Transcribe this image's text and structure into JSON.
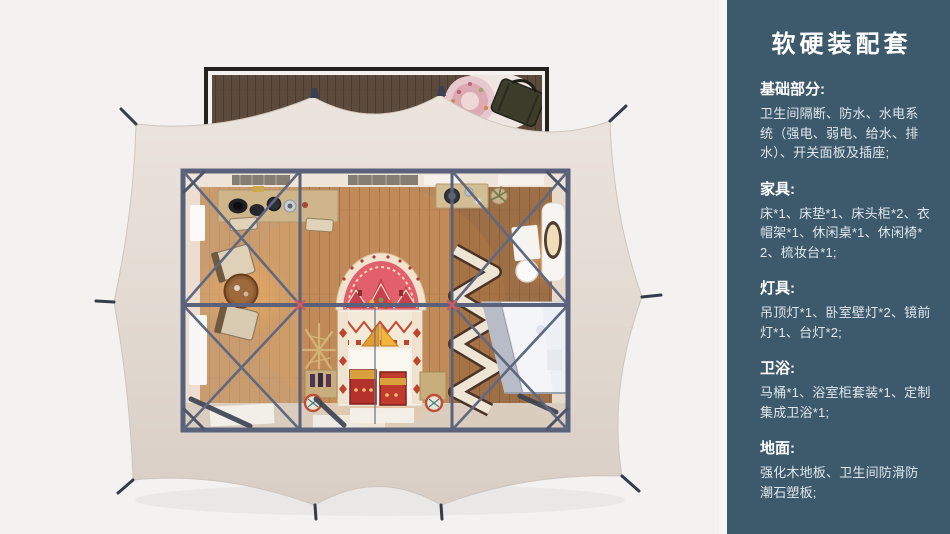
{
  "sidebar": {
    "title": "软硬装配套",
    "bg_color": "#3d5a6c",
    "text_color": "#dfe7ec",
    "sections": [
      {
        "heading": "基础部分:",
        "body": "卫生间隔断、防水、水电系统（强电、弱电、给水、排水）、开关面板及插座;"
      },
      {
        "heading": "家具:",
        "body": "床*1、床垫*1、床头柜*2、衣帽架*1、休闲桌*1、休闲椅*2、梳妆台*1;"
      },
      {
        "heading": "灯具:",
        "body": "吊顶灯*1、卧室壁灯*2、镜前灯*1、台灯*2;"
      },
      {
        "heading": "卫浴:",
        "body": "马桶*1、浴室柜套装*1、定制集成卫浴*1;"
      },
      {
        "heading": "地面:",
        "body": "强化木地板、卫生间防滑防潮石塑板;"
      }
    ]
  },
  "illustration": {
    "view": "top-down render of glamping tent suite",
    "colors": {
      "page_bg": "#f3f2f0",
      "tent_canvas": "#e6ded5",
      "steel_frame": "#59627a",
      "wood_floor": "#b9895c",
      "deck_wood": "#5c4b3d",
      "hub_marker": "#d4595f"
    },
    "components": [
      "deck",
      "deck-rug",
      "duffel-bag",
      "tent-canvas",
      "tent-pegs",
      "steel-frame",
      "bed",
      "mandala-headboard",
      "blanket-chests",
      "lounge-chairs",
      "tea-table",
      "console-desk",
      "washstand",
      "potted-plant",
      "coat-rack",
      "folding-screen",
      "vanity-table",
      "vanity-mirror",
      "vanity-stool",
      "integrated-bathroom",
      "shower-door",
      "wall-vents",
      "floor-mats"
    ]
  }
}
